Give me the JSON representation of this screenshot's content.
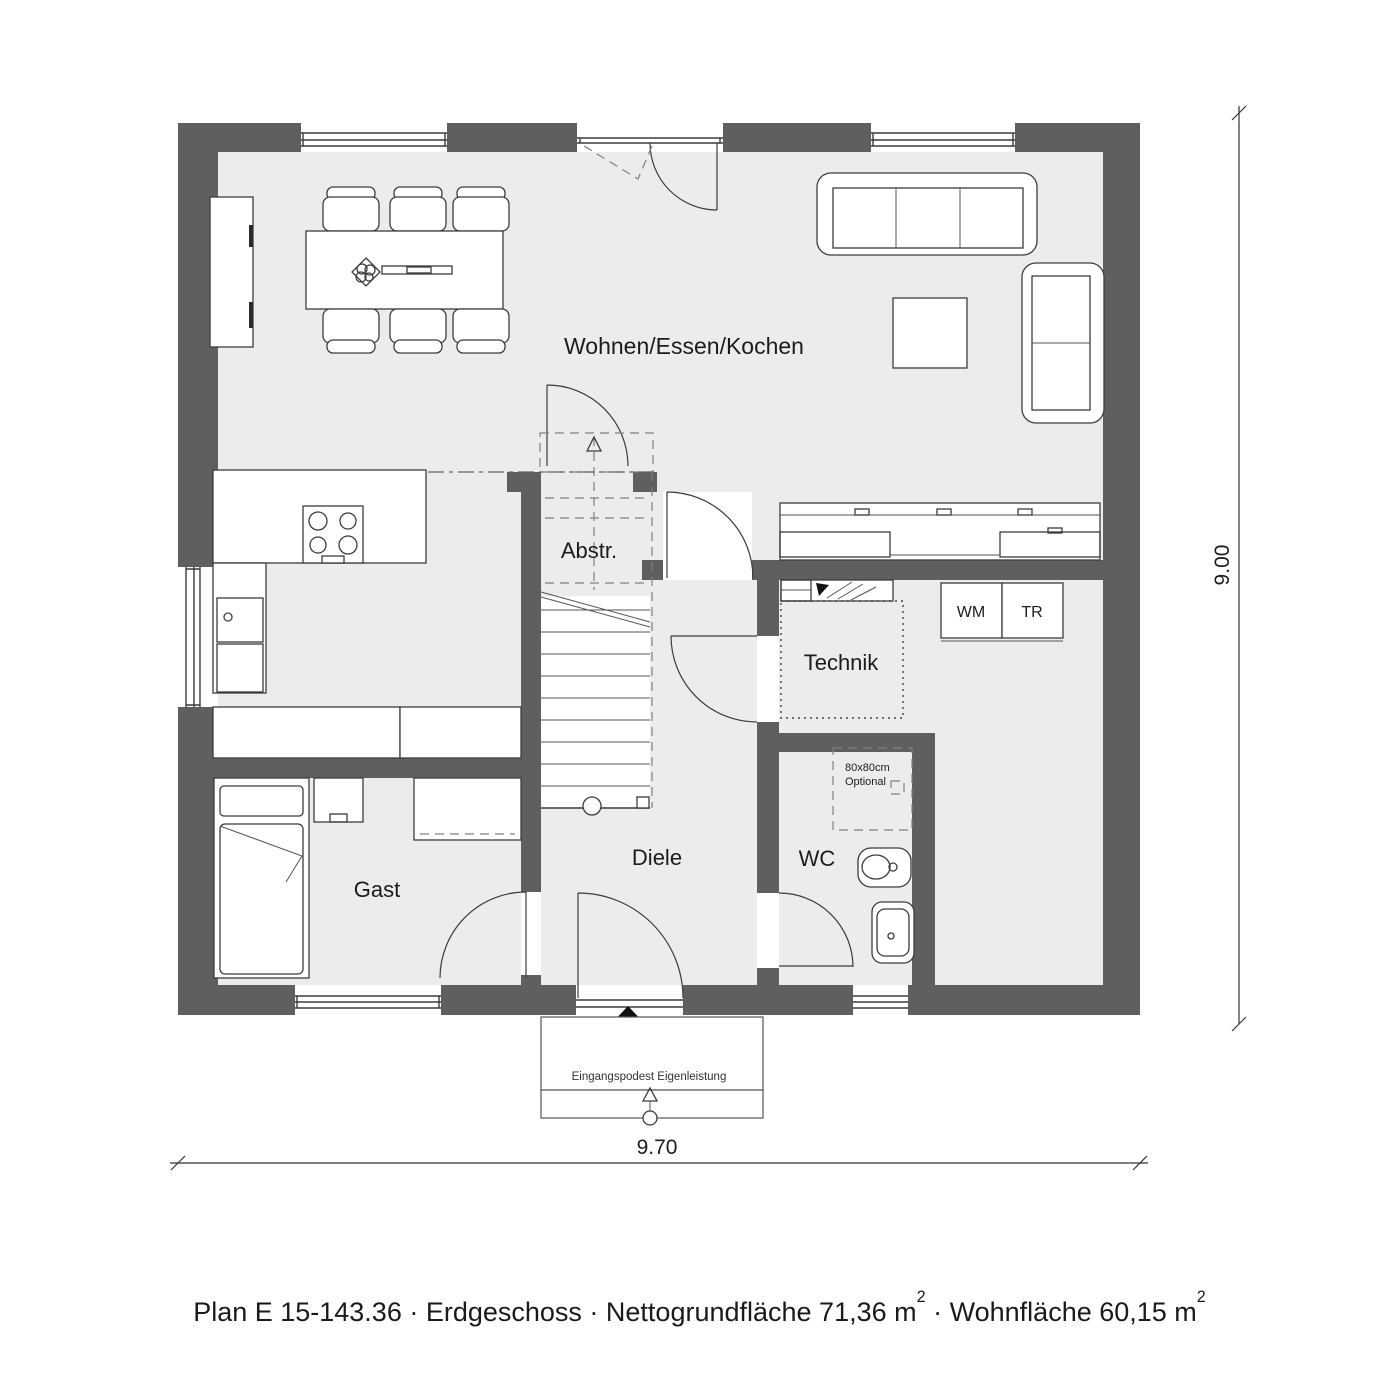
{
  "colors": {
    "wall": "#5f5f5f",
    "floor": "#ececec",
    "line": "#3c3c3c"
  },
  "labels": {
    "living": "Wohnen/Essen/Kochen",
    "storage": "Abstr.",
    "utility": "Technik",
    "washer": "WM",
    "dryer": "TR",
    "hall": "Diele",
    "guest": "Gast",
    "wc": "WC",
    "shower_size": "80x80cm",
    "shower_opt": "Optional",
    "entrance_note": "Eingangspodest Eigenleistung"
  },
  "dimensions": {
    "width": "9.70",
    "height": "9.00"
  },
  "caption": {
    "part1": "Plan E 15-143.36 · Erdgeschoss · Nettogrundfläche 71,36 m",
    "sup1": "2",
    "part2": " · Wohnfläche 60,15 m",
    "sup2": "2"
  }
}
